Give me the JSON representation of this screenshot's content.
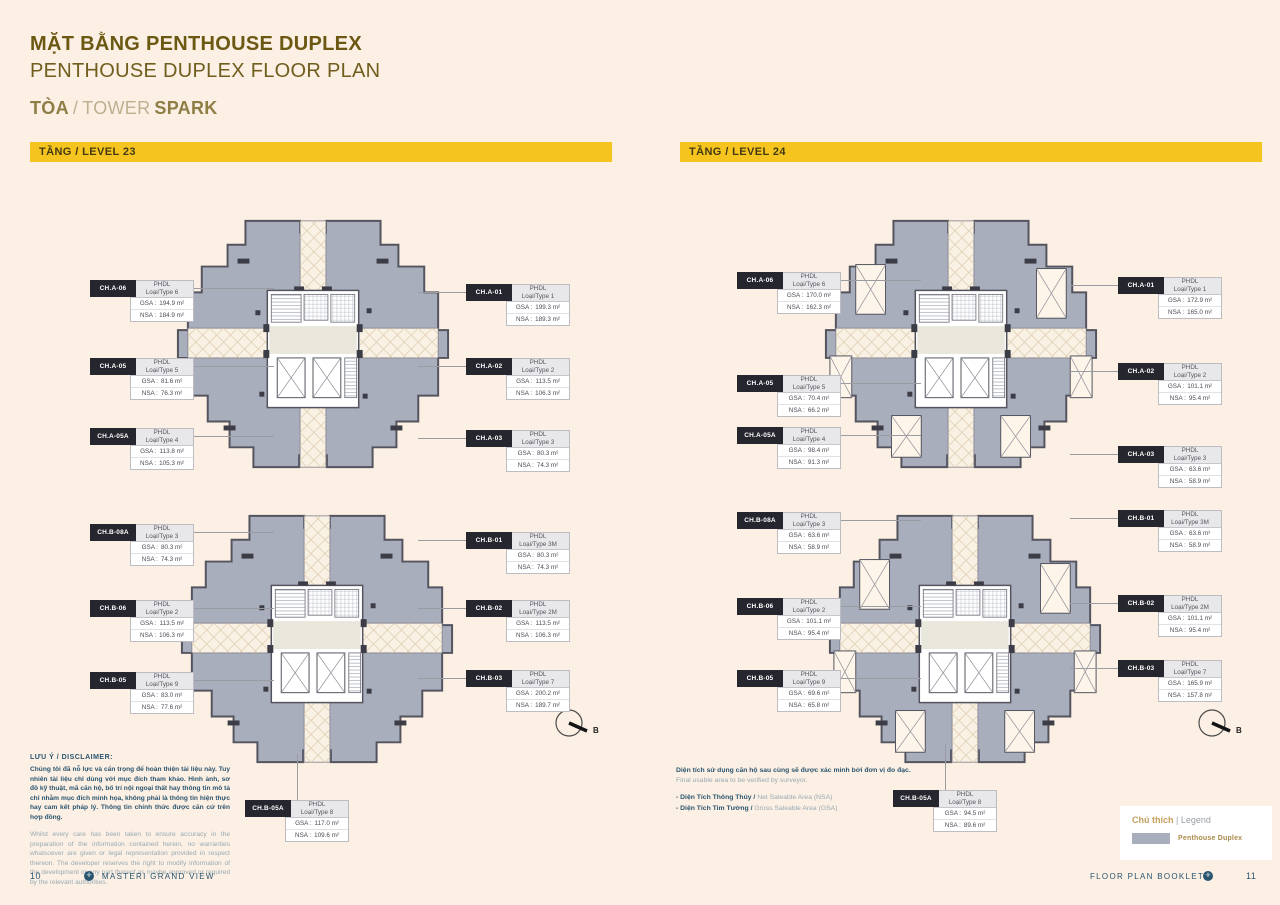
{
  "header": {
    "title_vi": "MẶT BẰNG PENTHOUSE DUPLEX",
    "title_en": "PENTHOUSE DUPLEX FLOOR PLAN",
    "tower_vi": "TÒA",
    "tower_sep": "/",
    "tower_en": "TOWER",
    "tower_name": "SPARK"
  },
  "labels": {
    "cls": "PHDL",
    "gsa": "GSA :",
    "nsa": "NSA :"
  },
  "compass": {
    "label": "B"
  },
  "levels": [
    {
      "banner": "TẦNG / LEVEL 23",
      "plans": [
        {
          "units_left": [
            {
              "code": "CH.A-06",
              "cls": "PHDL",
              "type": "Loại/Type 6",
              "gsa": "194.9 m²",
              "nsa": "184.9 m²"
            },
            {
              "code": "CH.A-05",
              "cls": "PHDL",
              "type": "Loại/Type 5",
              "gsa": "81.6 m²",
              "nsa": "76.3 m²"
            },
            {
              "code": "CH.A-05A",
              "cls": "PHDL",
              "type": "Loại/Type 4",
              "gsa": "113.8 m²",
              "nsa": "105.3 m²"
            }
          ],
          "units_right": [
            {
              "code": "CH.A-01",
              "cls": "PHDL",
              "type": "Loại/Type 1",
              "gsa": "199.3 m²",
              "nsa": "189.3 m²"
            },
            {
              "code": "CH.A-02",
              "cls": "PHDL",
              "type": "Loại/Type 2",
              "gsa": "113.5 m²",
              "nsa": "106.3 m²"
            },
            {
              "code": "CH.A-03",
              "cls": "PHDL",
              "type": "Loại/Type 3",
              "gsa": "80.3 m²",
              "nsa": "74.3 m²"
            }
          ]
        },
        {
          "units_left": [
            {
              "code": "CH.B-08A",
              "cls": "PHDL",
              "type": "Loại/Type 3",
              "gsa": "80.3 m²",
              "nsa": "74.3 m²"
            },
            {
              "code": "CH.B-06",
              "cls": "PHDL",
              "type": "Loại/Type 2",
              "gsa": "113.5 m²",
              "nsa": "106.3 m²"
            },
            {
              "code": "CH.B-05",
              "cls": "PHDL",
              "type": "Loại/Type 9",
              "gsa": "83.0 m²",
              "nsa": "77.6 m²"
            }
          ],
          "units_right": [
            {
              "code": "CH.B-01",
              "cls": "PHDL",
              "type": "Loại/Type 3M",
              "gsa": "80.3 m²",
              "nsa": "74.3 m²"
            },
            {
              "code": "CH.B-02",
              "cls": "PHDL",
              "type": "Loại/Type 2M",
              "gsa": "113.5 m²",
              "nsa": "106.3 m²"
            },
            {
              "code": "CH.B-03",
              "cls": "PHDL",
              "type": "Loại/Type 7",
              "gsa": "200.2 m²",
              "nsa": "189.7 m²"
            }
          ],
          "units_bottom": [
            {
              "code": "CH.B-05A",
              "cls": "PHDL",
              "type": "Loại/Type 8",
              "gsa": "117.0 m²",
              "nsa": "109.6 m²"
            }
          ]
        }
      ]
    },
    {
      "banner": "TẦNG / LEVEL 24",
      "plans": [
        {
          "units_left": [
            {
              "code": "CH.A-06",
              "cls": "PHDL",
              "type": "Loại/Type 6",
              "gsa": "170.0 m²",
              "nsa": "162.3 m²"
            },
            {
              "code": "CH.A-05",
              "cls": "PHDL",
              "type": "Loại/Type 5",
              "gsa": "70.4 m²",
              "nsa": "66.2 m²"
            },
            {
              "code": "CH.A-05A",
              "cls": "PHDL",
              "type": "Loại/Type 4",
              "gsa": "98.4 m²",
              "nsa": "91.3 m²"
            }
          ],
          "units_right": [
            {
              "code": "CH.A-01",
              "cls": "PHDL",
              "type": "Loại/Type 1",
              "gsa": "172.9 m²",
              "nsa": "165.0 m²"
            },
            {
              "code": "CH.A-02",
              "cls": "PHDL",
              "type": "Loại/Type 2",
              "gsa": "101.1 m²",
              "nsa": "95.4 m²"
            },
            {
              "code": "CH.A-03",
              "cls": "PHDL",
              "type": "Loại/Type 3",
              "gsa": "63.6 m²",
              "nsa": "58.9 m²"
            }
          ]
        },
        {
          "units_left": [
            {
              "code": "CH.B-08A",
              "cls": "PHDL",
              "type": "Loại/Type 3",
              "gsa": "63.6 m²",
              "nsa": "58.9 m²"
            },
            {
              "code": "CH.B-06",
              "cls": "PHDL",
              "type": "Loại/Type 2",
              "gsa": "101.1 m²",
              "nsa": "95.4 m²"
            },
            {
              "code": "CH.B-05",
              "cls": "PHDL",
              "type": "Loại/Type 9",
              "gsa": "69.6 m²",
              "nsa": "65.8 m²"
            }
          ],
          "units_right": [
            {
              "code": "CH.B-01",
              "cls": "PHDL",
              "type": "Loại/Type 3M",
              "gsa": "63.6 m²",
              "nsa": "58.9 m²"
            },
            {
              "code": "CH.B-02",
              "cls": "PHDL",
              "type": "Loại/Type 2M",
              "gsa": "101.1 m²",
              "nsa": "95.4 m²"
            },
            {
              "code": "CH.B-03",
              "cls": "PHDL",
              "type": "Loại/Type 7",
              "gsa": "165.9 m²",
              "nsa": "157.8 m²"
            }
          ],
          "units_bottom": [
            {
              "code": "CH.B-05A",
              "cls": "PHDL",
              "type": "Loại/Type 8",
              "gsa": "94.5 m²",
              "nsa": "89.6 m²"
            }
          ]
        }
      ]
    }
  ],
  "disclaimer": {
    "heading": "LƯU Ý / DISCLAIMER:",
    "vi": "Chúng tôi đã nỗ lực và cẩn trọng để hoàn thiện tài liệu này. Tuy nhiên tài liệu chỉ dùng với mục đích tham khảo. Hình ảnh, sơ đồ kỹ thuật, mã căn hộ, bố trí nội ngoại thất hay thông tin mô tả chỉ nhằm mục đích minh họa, không phải là thông tin hiện thực hay cam kết pháp lý. Thông tin chính thức được căn cứ trên hợp đồng.",
    "en": "Whilst every care has been taken to ensure accuracy in the preparation of the information contained herein, no warranties whatsoever are given or legal representation provided in respect thereon. The developer reserves the right to modify information of the development or any part thereof as maybe approved or required by the relevant authorities."
  },
  "note": {
    "vi": "Diện tích sử dụng căn hộ sau cùng sẽ được xác minh bởi đơn vị đo đạc.",
    "en": "Final usable area to be verified by surveyor.",
    "items": [
      {
        "vi": "-  Diện Tích Thông Thủy /",
        "en": "Net Saleable Area (NSA)"
      },
      {
        "vi": "-  Diện Tích Tim Tường /",
        "en": "Gross Saleable Area (GSA)"
      }
    ]
  },
  "legend": {
    "title_vi": "Chú thích",
    "title_sep": "|",
    "title_en": "Legend",
    "item": "Penthouse Duplex",
    "swatch_color": "#A9AEBD"
  },
  "footer": {
    "page_left": "10",
    "brand": "MASTERI GRAND VIEW",
    "booklet": "FLOOR PLAN BOOKLET",
    "page_right": "11",
    "mark": "✛"
  },
  "colors": {
    "background": "#FCEFE3",
    "accent_yellow": "#F6C41F",
    "plan_fill": "#A9AEBD",
    "tag_bg": "#26262E",
    "title_gold": "#6B5913",
    "text_blue": "#2A5570"
  }
}
